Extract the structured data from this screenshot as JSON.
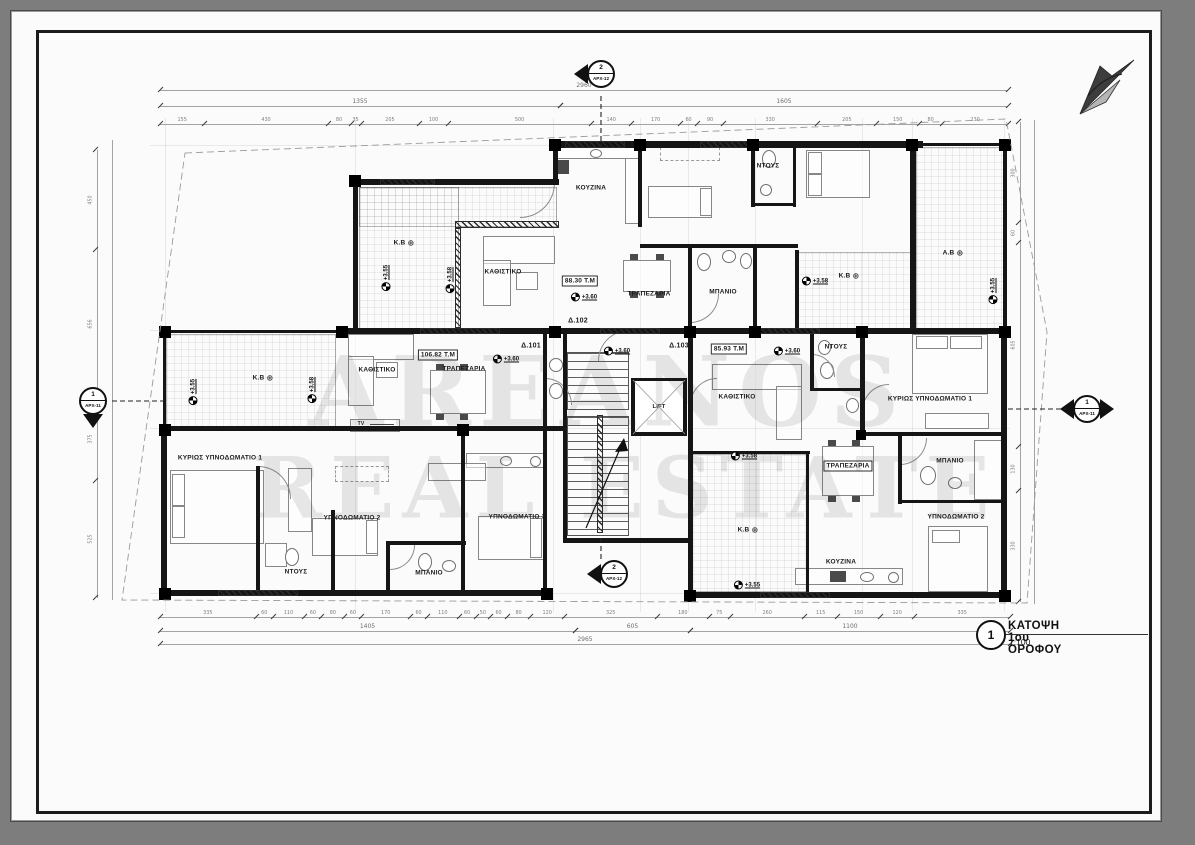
{
  "title_block": {
    "number": "1",
    "title": "ΚΑΤΟΨΗ 1ου ΟΡΟΦΟΥ",
    "scale": "1:100"
  },
  "watermark": {
    "line1": "AREANOS",
    "line2": "REAL ESTATE"
  },
  "section_markers": [
    {
      "pos": "top",
      "num": "2",
      "ref": "ΑΡΧ-12"
    },
    {
      "pos": "bottom",
      "num": "2",
      "ref": "ΑΡΧ-12"
    },
    {
      "pos": "left",
      "num": "1",
      "ref": "ΑΡΧ-11"
    },
    {
      "pos": "right",
      "num": "1",
      "ref": "ΑΡΧ-11"
    }
  ],
  "apartments": [
    {
      "id": "Δ.101",
      "area": "106.82 Τ.Μ"
    },
    {
      "id": "Δ.102",
      "area": "88.30 Τ.Μ"
    },
    {
      "id": "Δ.103",
      "area": "85.93 Τ.Μ"
    }
  ],
  "labels": {
    "lift": "LIFT",
    "tv": "TV",
    "rooms": [
      {
        "t": "ΚΟΥΖΙΝΑ",
        "x": 591,
        "y": 188
      },
      {
        "t": "ΚΑΘΙΣΤΙΚΟ",
        "x": 503,
        "y": 272
      },
      {
        "t": "ΤΡΑΠΕΖΑΡΙΑ",
        "x": 649,
        "y": 294
      },
      {
        "t": "ΜΠΑΝΙΟ",
        "x": 723,
        "y": 292
      },
      {
        "t": "ΝΤΟΥΣ",
        "x": 768,
        "y": 166
      },
      {
        "t": "Κ.Β",
        "circ": true,
        "x": 404,
        "y": 243
      },
      {
        "t": "Κ.Β",
        "circ": true,
        "x": 849,
        "y": 276
      },
      {
        "t": "Α.Β",
        "circ": true,
        "x": 953,
        "y": 253
      },
      {
        "t": "Κ.Β",
        "circ": true,
        "x": 263,
        "y": 378
      },
      {
        "t": "ΚΑΘΙΣΤΙΚΟ",
        "x": 377,
        "y": 370
      },
      {
        "t": "ΤΡΑΠΕΖΑΡΙΑ",
        "x": 464,
        "y": 369
      },
      {
        "t": "ΚΑΘΙΣΤΙΚΟ",
        "x": 737,
        "y": 397
      },
      {
        "t": "ΝΤΟΥΣ",
        "x": 836,
        "y": 347
      },
      {
        "t": "ΚΥΡΙΩΣ ΥΠΝΟΔΩΜΑΤΙΟ 1",
        "x": 930,
        "y": 399
      },
      {
        "t": "ΜΠΑΝΙΟ",
        "x": 950,
        "y": 461
      },
      {
        "t": "ΥΠΝΟΔΩΜΑΤΙΟ 2",
        "x": 956,
        "y": 517
      },
      {
        "t": "ΤΡΑΠΕΖΑΡΙΑ",
        "box": true,
        "x": 848,
        "y": 466
      },
      {
        "t": "Κ.Β",
        "circ": true,
        "x": 748,
        "y": 530
      },
      {
        "t": "ΚΟΥΖΙΝΑ",
        "x": 841,
        "y": 562
      },
      {
        "t": "ΚΥΡΙΩΣ ΥΠΝΟΔΩΜΑΤΙΟ 1",
        "x": 220,
        "y": 458
      },
      {
        "t": "ΥΠΝΟΔΩΜΑΤΙΟ 2",
        "x": 352,
        "y": 518
      },
      {
        "t": "ΝΤΟΥΣ",
        "x": 296,
        "y": 572
      },
      {
        "t": "ΜΠΑΝΙΟ",
        "x": 429,
        "y": 573
      },
      {
        "t": "ΥΠΝΟΔΩΜΑΤΙΟ 3",
        "x": 517,
        "y": 517
      }
    ],
    "apartment_ids": [
      {
        "t": "Δ.102",
        "x": 578,
        "y": 321
      },
      {
        "t": "Δ.101",
        "x": 531,
        "y": 346
      },
      {
        "t": "Δ.103",
        "x": 679,
        "y": 346
      }
    ],
    "areas": [
      {
        "t": "88.30 Τ.Μ",
        "x": 580,
        "y": 281
      },
      {
        "t": "106.82 Τ.Μ",
        "x": 438,
        "y": 355
      },
      {
        "t": "85.93 Τ.Μ",
        "x": 729,
        "y": 349
      }
    ],
    "levels": [
      {
        "t": "+3.60",
        "x": 584,
        "y": 297
      },
      {
        "t": "+3.60",
        "x": 506,
        "y": 359
      },
      {
        "t": "+3.60",
        "x": 617,
        "y": 351
      },
      {
        "t": "+3.60",
        "x": 787,
        "y": 351
      },
      {
        "t": "+3.58",
        "x": 815,
        "y": 281
      },
      {
        "t": "+3.58",
        "x": 744,
        "y": 456
      },
      {
        "t": "+3.55",
        "x": 747,
        "y": 585
      },
      {
        "t": "+3.55",
        "x": 386,
        "y": 278,
        "rot": true
      },
      {
        "t": "+3.58",
        "x": 450,
        "y": 280,
        "rot": true
      },
      {
        "t": "+3.55",
        "x": 193,
        "y": 392,
        "rot": true
      },
      {
        "t": "+3.58",
        "x": 312,
        "y": 390,
        "rot": true
      },
      {
        "t": "+3.55",
        "x": 993,
        "y": 291,
        "rot": true
      }
    ]
  },
  "dimensions": {
    "top_total": "2960",
    "top_subtotals": [
      "1355",
      "1605"
    ],
    "top_segments": [
      "155",
      "430",
      "80",
      "35",
      "205",
      "100",
      "500",
      "140",
      "170",
      "60",
      "90",
      "330",
      "205",
      "150",
      "80",
      "230"
    ],
    "bottom_total": "2965",
    "bottom_subtotals": [
      "1405",
      "605",
      "1100"
    ],
    "bottom_segments": [
      "335",
      "60",
      "110",
      "60",
      "80",
      "60",
      "170",
      "60",
      "110",
      "60",
      "50",
      "60",
      "80",
      "120",
      "325",
      "180",
      "75",
      "260",
      "115",
      "150",
      "120",
      "335"
    ],
    "left_segments": [
      "450",
      "656",
      "375",
      "525"
    ],
    "right_segments": [
      "300",
      "60",
      "605",
      "130",
      "330"
    ]
  }
}
